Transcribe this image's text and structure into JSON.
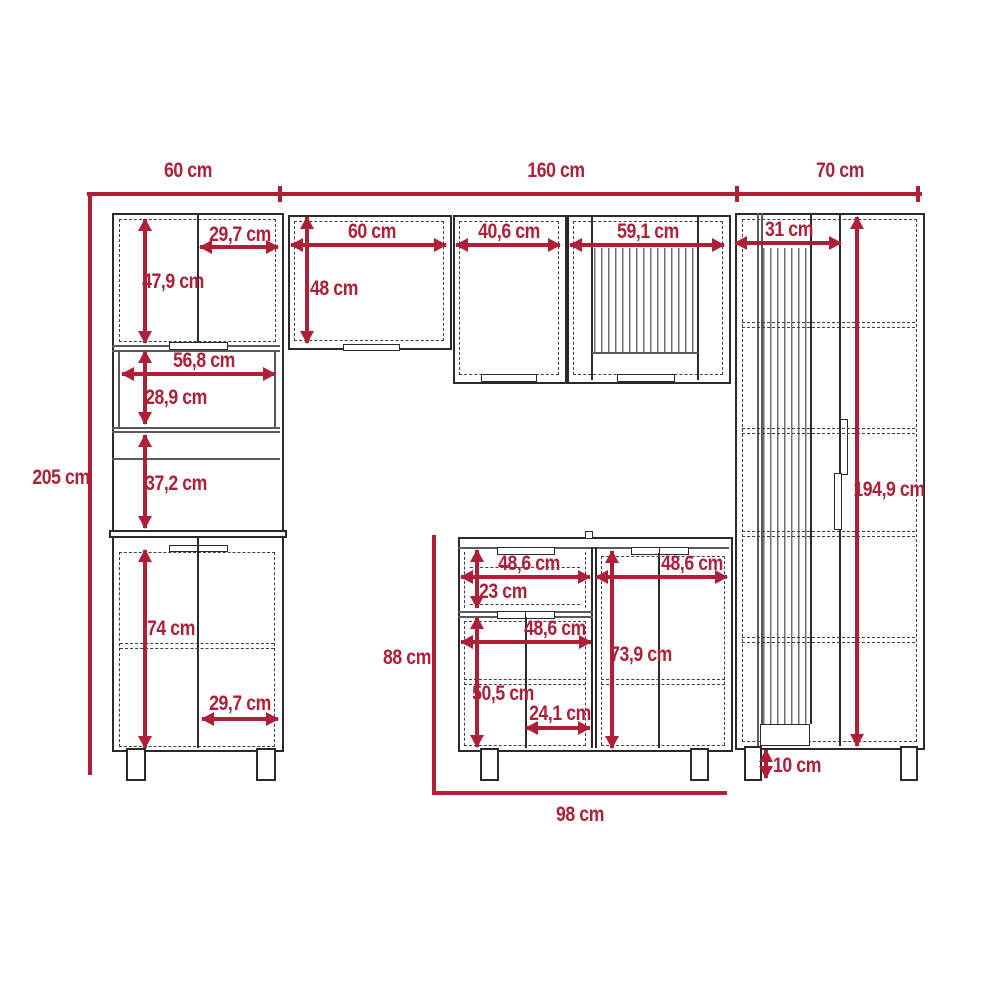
{
  "diagram": {
    "type": "furniture-dimension-drawing",
    "subject": "modular kitchen cabinet set elevation",
    "units": "cm"
  },
  "colors": {
    "dimension": "#ae2038",
    "outline": "#2a2a2a",
    "innerline": "#5a5a5a",
    "dashed": "#3f3f3f",
    "slat": "#6f6f6f"
  },
  "dims": {
    "top_left": "60 cm",
    "top_middle": "160 cm",
    "top_right": "70 cm",
    "total_height": "205 cm",
    "pantry_upper_door_width": "29,7 cm",
    "pantry_upper_door_height": "47,9 cm",
    "pantry_niche_width": "56,8 cm",
    "pantry_niche_height": "28,9 cm",
    "pantry_mid_height": "37,2 cm",
    "pantry_lower_door_height": "74 cm",
    "pantry_lower_door_width": "29,7 cm",
    "wall_cab1_width": "60 cm",
    "wall_cab1_height": "48 cm",
    "wall_cab2_width": "40,6 cm",
    "wall_cab3_width": "59,1 cm",
    "tall_door_width": "31 cm",
    "tall_height": "194,9 cm",
    "tall_leg_height": "10 cm",
    "base_height": "88 cm",
    "base_width": "98 cm",
    "base_drawer_width": "48,6 cm",
    "base_drawer_height": "23 cm",
    "base_right_width": "48,6 cm",
    "base_right_height": "73,9 cm",
    "base_lower_width": "48,6 cm",
    "base_lower_height": "50,5 cm",
    "base_door_width": "24,1 cm"
  }
}
